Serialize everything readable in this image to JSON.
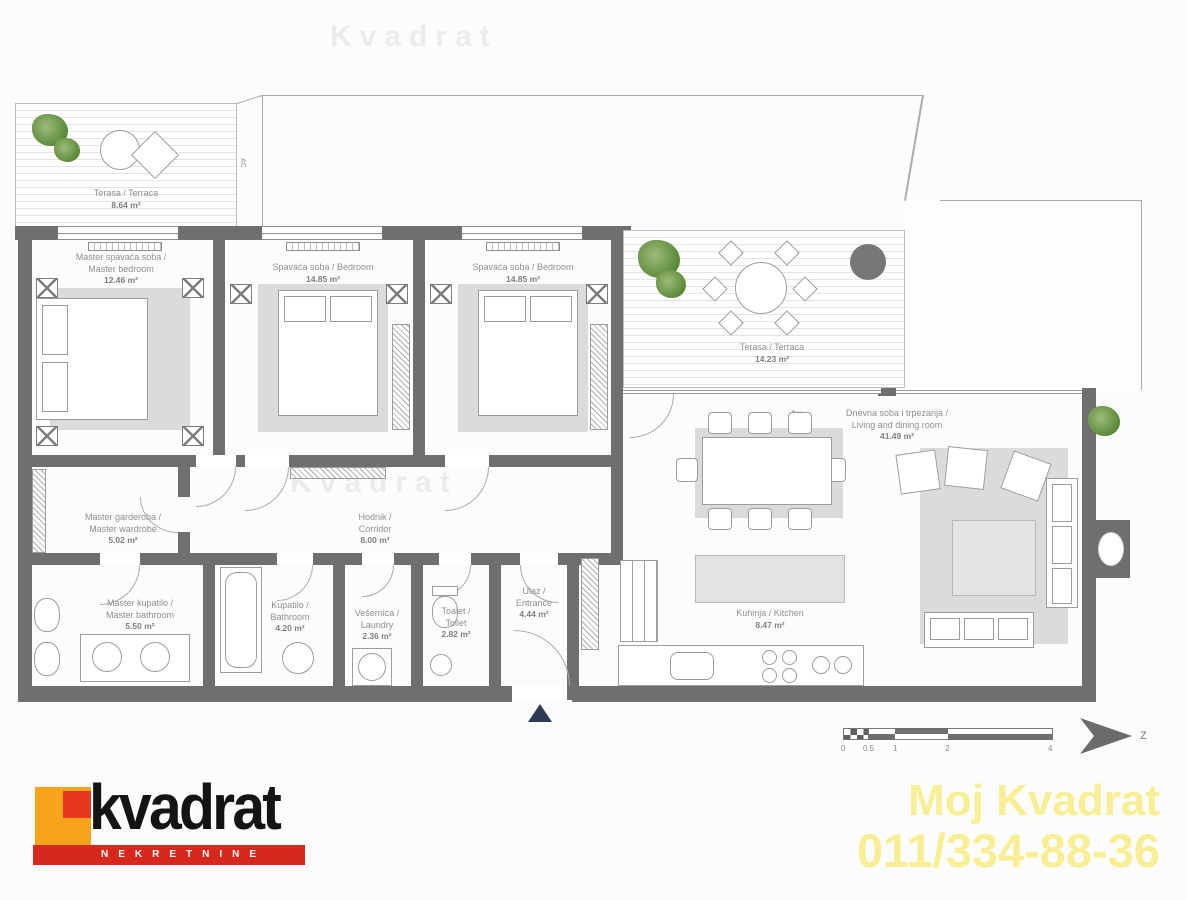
{
  "rooms": {
    "terrace_top": {
      "name": "Terasa / Terraca",
      "area": "8.64 m²"
    },
    "master_bedroom": {
      "name": "Master spavaća soba /",
      "name2": "Master bedroom",
      "area": "12.46 m²"
    },
    "bedroom_a": {
      "name": "Spavaća soba / Bedroom",
      "area": "14.85 m²"
    },
    "bedroom_b": {
      "name": "Spavaća soba / Bedroom",
      "area": "14.85 m²"
    },
    "terrace_main": {
      "name": "Terasa / Terraca",
      "area": "14.23 m²"
    },
    "living": {
      "name": "Dnevna soba i trpezarija /",
      "name2": "Living and dining room",
      "area": "41.49 m²"
    },
    "wardrobe": {
      "name": "Master garderoba /",
      "name2": "Master wardrobe",
      "area": "5.02 m²"
    },
    "corridor": {
      "name": "Hodnik /",
      "name2": "Corridor",
      "area": "8.00 m²"
    },
    "master_bathroom": {
      "name": "Master kupatilo /",
      "name2": "Master bathroom",
      "area": "5.50 m²"
    },
    "bathroom": {
      "name": "Kupatilo /",
      "name2": "Bathroom",
      "area": "4.20 m²"
    },
    "laundry": {
      "name": "Vešernica /",
      "name2": "Laundry",
      "area": "2.36 m²"
    },
    "toilet": {
      "name": "Toalet /",
      "name2": "Toilet",
      "area": "2.82 m²"
    },
    "entrance": {
      "name": "Ulaz /",
      "name2": "Entrance",
      "area": "4.44 m²"
    },
    "kitchen": {
      "name": "Kuhinja / Kitchen",
      "area": "8.47 m²"
    }
  },
  "annotations": {
    "ac_label": "AC",
    "compass_label": "z",
    "arrow": "←",
    "watermark": "Kvadrat"
  },
  "scale_bar": {
    "ticks": [
      "0",
      "0.5",
      "1",
      "2",
      "4"
    ]
  },
  "branding": {
    "logo_word": "kvadrat",
    "logo_tagline": "NEKRETNINE",
    "promo_line1": "Moj Kvadrat",
    "promo_line2": "011/334-88-36"
  },
  "colors": {
    "wall": "#6f6f6f",
    "logo_orange": "#f7a41d",
    "logo_red": "#e8361f",
    "banner_red": "#d7281d",
    "promo_yellow": "#f8ee93",
    "plant_green": "#5c8a39"
  }
}
